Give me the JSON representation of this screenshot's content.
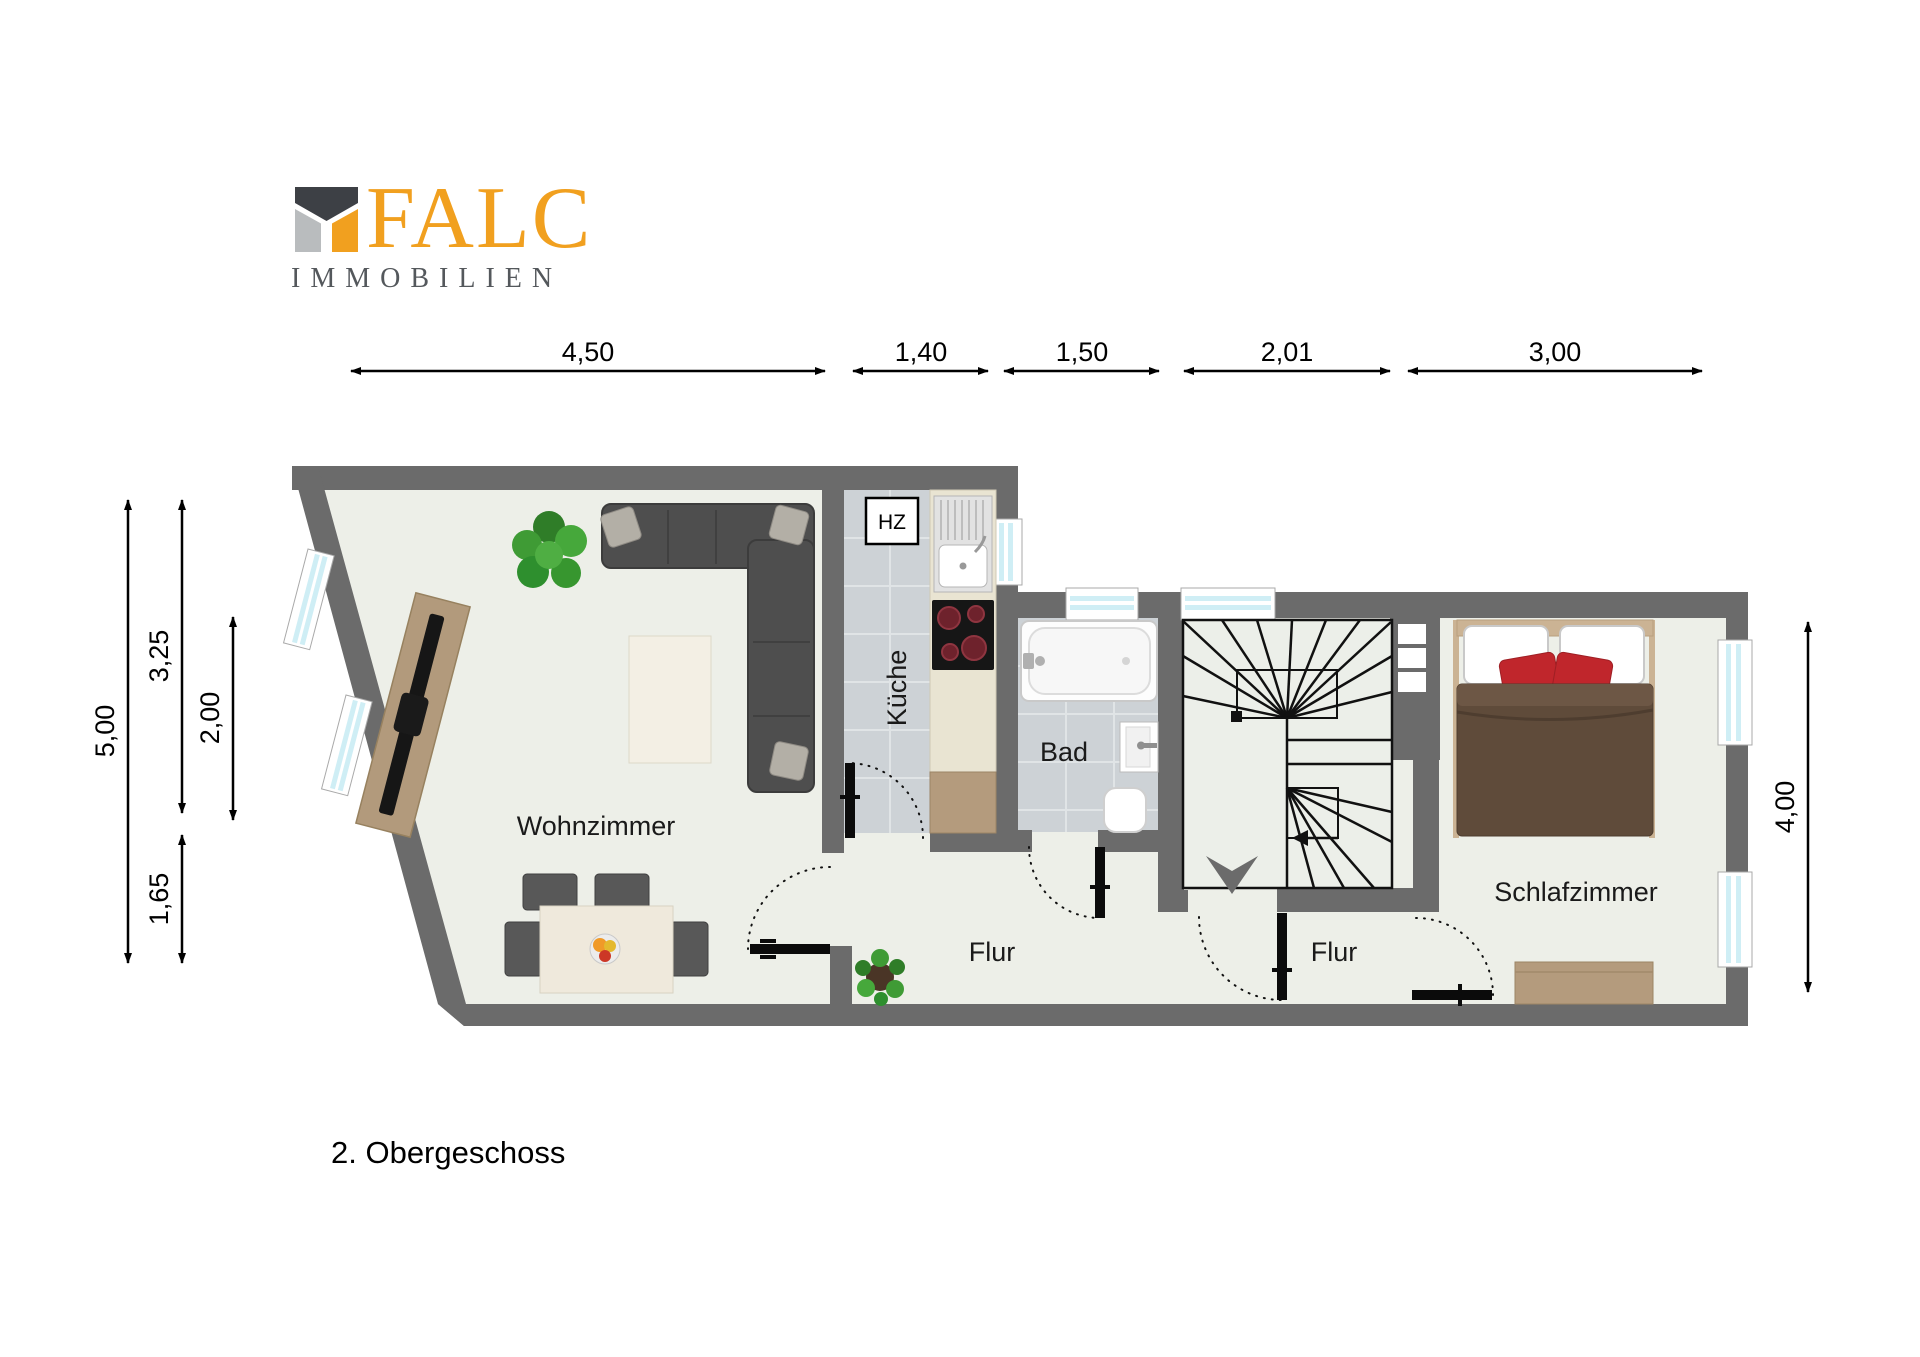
{
  "logo": {
    "name": "FALC",
    "subtitle": "IMMOBILIEN"
  },
  "floor_label": "2. Obergeschoss",
  "rooms": {
    "living": "Wohnzimmer",
    "kitchen": "Küche",
    "bath": "Bad",
    "hall_left": "Flur",
    "hall_right": "Flur",
    "bedroom": "Schlafzimmer",
    "heating": "HZ"
  },
  "dimensions": {
    "top": [
      "4,50",
      "1,40",
      "1,50",
      "2,01",
      "3,00"
    ],
    "left": [
      "5,00",
      "3,25",
      "2,00",
      "1,65"
    ],
    "right": [
      "4,00"
    ]
  },
  "colors": {
    "wall": "#6b6b6b",
    "floor": "#edefe8",
    "tile": "#cdd2d6",
    "brand_orange": "#f1a01f",
    "brand_gray": "#54585c",
    "window_glass": "#cfeef5"
  }
}
